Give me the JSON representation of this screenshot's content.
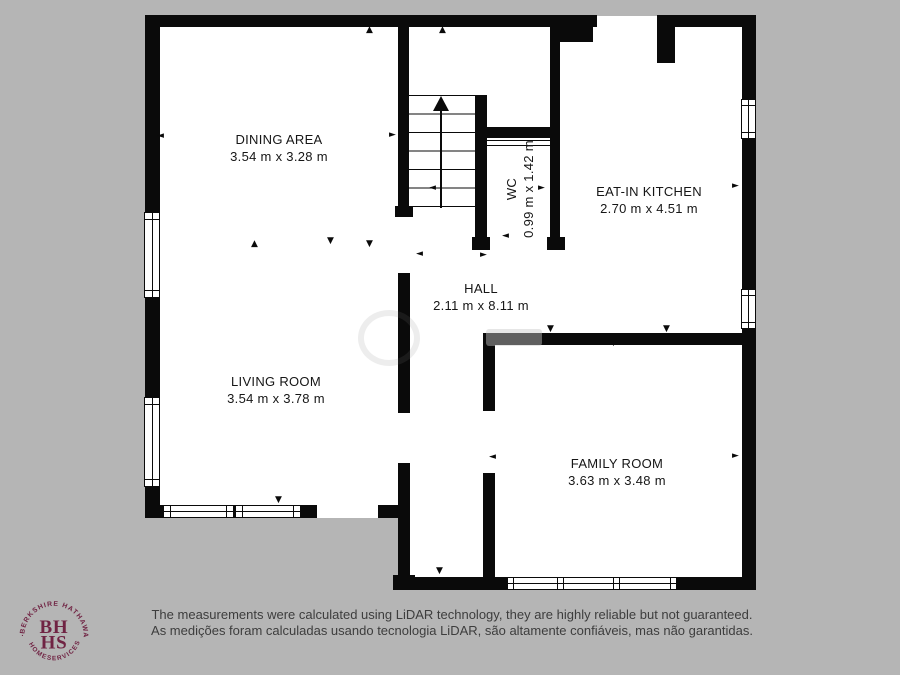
{
  "colors": {
    "background": "#b5b5b5",
    "wall": "#0a0a0a",
    "room_fill": "#ffffff",
    "brand_maroon": "#702343"
  },
  "icons": {
    "up": "▲",
    "down": "▼",
    "left": "◄",
    "right": "►"
  },
  "rooms": [
    {
      "name": "DINING AREA",
      "dimensions": "3.54 m x 3.28 m"
    },
    {
      "name": "EAT-IN KITCHEN",
      "dimensions": "2.70 m x 4.51 m"
    },
    {
      "name": "WC",
      "dimensions": "0.99 m x 1.42 m"
    },
    {
      "name": "HALL",
      "dimensions": "2.11 m x 8.11 m"
    },
    {
      "name": "LIVING ROOM",
      "dimensions": "3.54 m x 3.78 m"
    },
    {
      "name": "FAMILY ROOM",
      "dimensions": "3.63 m x 3.48 m"
    }
  ],
  "logo": {
    "monogram_top": "BH",
    "monogram_bottom": "HS",
    "arc_top": "BERKSHIRE HATHAWAY",
    "arc_bottom": "HOMESERVICES",
    "separator": "·"
  },
  "footer": {
    "disclaimer_en": "The measurements were calculated using LiDAR technology, they are highly reliable but not guaranteed.",
    "disclaimer_pt": "As medições foram calculadas usando tecnologia LiDAR, são altamente confiáveis, mas não garantidas."
  }
}
